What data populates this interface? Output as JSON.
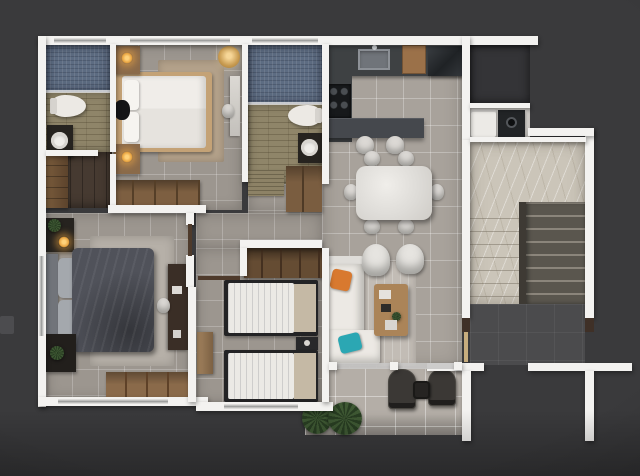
{
  "meta": {
    "description": "3D rendered top-down floor plan of a three-bedroom apartment with staircase and balcony",
    "view": "top-down architectural render",
    "canvas": {
      "width": 640,
      "height": 476
    }
  },
  "palette": {
    "background": "#3a3a3c",
    "wall": "#f3f2f0",
    "floor_tile": "#9c968f",
    "floor_tile_light": "#a8a29b",
    "balcony_tile": "#b4aea7",
    "bathroom_tile": "#8f8569",
    "shower_tile": "#5d6c82",
    "wood_floor_dark": "#463a31",
    "wood_mid": "#8a6a4a",
    "counter_dark": "#3e4143",
    "appliance_dark": "#26292c",
    "marble_light": "#cbc5b9",
    "stair_dark": "#5a564e",
    "landing_dark": "#4b4b4d",
    "bed_white": "#ece9e4",
    "duvet_dark": "#50525a",
    "rug_tan": "#b3a18a",
    "rug_gray": "#b6b0a8",
    "accent_orange": "#d8792f",
    "accent_teal": "#2ba7b3",
    "plant_green": "#3e5833",
    "lamp_glow": "#e8a33f",
    "door_brown": "#4e3a2b",
    "window_glass": "#c9c8c6"
  },
  "rooms": [
    {
      "id": "bathroom-1",
      "label": "Bathroom 1",
      "features": [
        "shower",
        "toilet",
        "washbasin-vanity"
      ]
    },
    {
      "id": "walk-in-closet",
      "label": "Walk-in Closet",
      "features": [
        "wardrobe-cabinet"
      ]
    },
    {
      "id": "bedroom-1",
      "label": "Bedroom 1",
      "features": [
        "double-bed",
        "nightstands",
        "wardrobe",
        "pendant-lamp",
        "rug",
        "mirror"
      ]
    },
    {
      "id": "bathroom-2",
      "label": "Bathroom 2",
      "features": [
        "shower",
        "toilet",
        "washbasin-vanity"
      ]
    },
    {
      "id": "kitchen",
      "label": "Kitchen",
      "features": [
        "counter",
        "sink",
        "cooktop",
        "fridge",
        "island",
        "bar-stools"
      ]
    },
    {
      "id": "dining-area",
      "label": "Dining Area",
      "features": [
        "dining-table",
        "six-chairs"
      ]
    },
    {
      "id": "living-room",
      "label": "Living Room",
      "features": [
        "corner-sofa",
        "armchairs",
        "coffee-table",
        "rug"
      ]
    },
    {
      "id": "hallway",
      "label": "Hallway",
      "features": [
        "doormat",
        "linen-closet"
      ]
    },
    {
      "id": "master-bedroom",
      "label": "Master Bedroom",
      "features": [
        "double-bed",
        "desk",
        "wardrobe",
        "nightstands",
        "rug",
        "plants"
      ]
    },
    {
      "id": "twin-bedroom",
      "label": "Twin Bedroom",
      "features": [
        "twin-beds",
        "nightstand",
        "wardrobe",
        "dresser"
      ]
    },
    {
      "id": "utility-nook",
      "label": "Utility Nook",
      "features": [
        "washing-machine",
        "dryer"
      ]
    },
    {
      "id": "staircase",
      "label": "Staircase",
      "features": [
        "marble-landing",
        "stair-flight",
        "entry-doorways"
      ]
    },
    {
      "id": "balcony",
      "label": "Balcony",
      "features": [
        "lounge-chairs",
        "side-table",
        "palm-plants"
      ]
    }
  ]
}
